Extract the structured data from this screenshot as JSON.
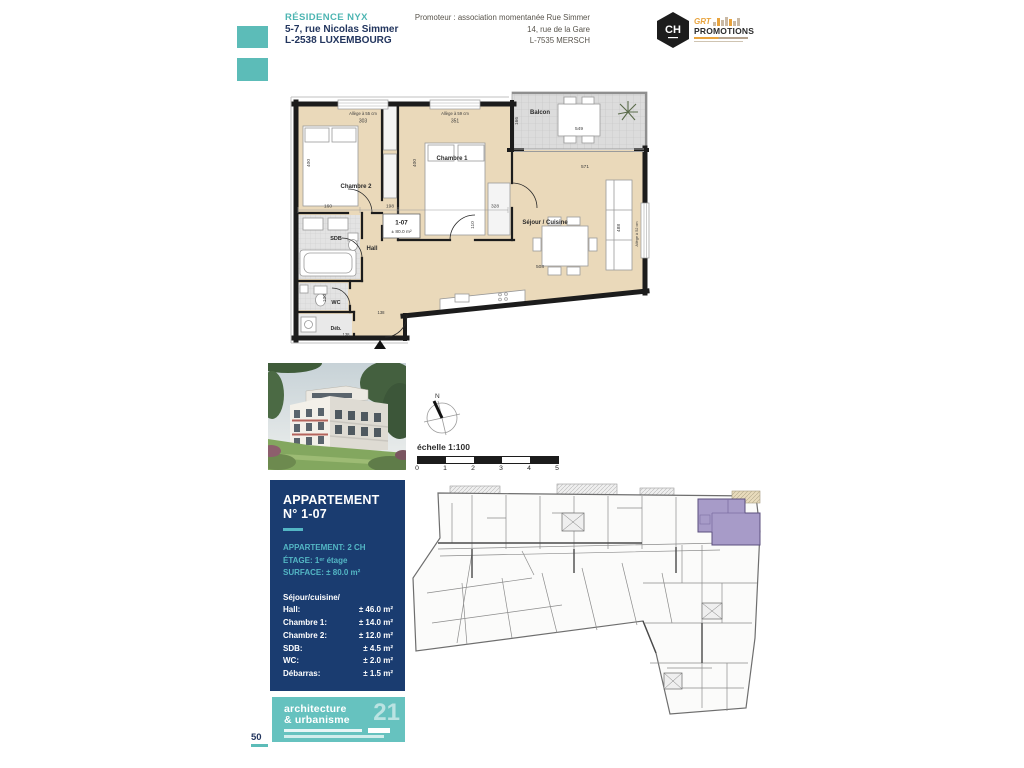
{
  "header": {
    "residence_name": "RÉSIDENCE NYX",
    "residence_address_1": "5-7, rue Nicolas Simmer",
    "residence_address_2": "L-2538 LUXEMBOURG",
    "promoter_line_1": "Promoteur : association momentanée Rue Simmer",
    "promoter_line_2": "14, rue de la Gare",
    "promoter_line_3": "L-7535 MERSCH",
    "ch_logo_text": "CH",
    "grt_logo_top": "GRT",
    "grt_logo_bottom": "PROMOTIONS"
  },
  "floor_plan": {
    "unit_id": "1-07",
    "unit_area": "± 80.0 m²",
    "rooms": {
      "chambre1": "Chambre 1",
      "chambre2": "Chambre 2",
      "balcon": "Balcon",
      "sejour_cuisine": "Séjour / Cuisine",
      "hall": "Hall",
      "sdb": "SDB",
      "wc": "WC",
      "debarras": "Déb."
    },
    "annotations": {
      "allege_55": "Allège à 55 cm",
      "allege_59": "Allège à 59 cm",
      "allege_52": "Allège à 52 cm"
    },
    "dims": {
      "chambre2_width": "303",
      "chambre1_width": "351",
      "chambre2_depth": "400",
      "chambre1_depth": "400",
      "balcon_depth": "166",
      "balcon_width": "549",
      "sejour_width": "571",
      "sejour_depth": "488",
      "sdb_width": "160",
      "hall_width": "198",
      "sejour_left": "328",
      "dining_width": "508",
      "corridor": "110",
      "wc_depth": "100",
      "hall_door": "138",
      "deb_width": "138"
    }
  },
  "compass": {
    "north": "N"
  },
  "scale": {
    "label": "échelle 1:100",
    "ticks": [
      "0",
      "1",
      "2",
      "3",
      "4",
      "5"
    ]
  },
  "info_box": {
    "title_line_1": "APPARTEMENT",
    "title_line_2": "N° 1-07",
    "specs": [
      {
        "label": "APPARTEMENT:",
        "value": "2 CH"
      },
      {
        "label": "ÉTAGE:",
        "value": "1ᵉʳ étage"
      },
      {
        "label": "SURFACE:",
        "value": "± 80.0 m²"
      }
    ],
    "rooms": [
      {
        "label": "Séjour/cuisine/",
        "value": ""
      },
      {
        "label": "Hall:",
        "value": "± 46.0 m²"
      },
      {
        "label": "Chambre 1:",
        "value": "± 14.0 m²"
      },
      {
        "label": "Chambre 2:",
        "value": "± 12.0 m²"
      },
      {
        "label": "SDB:",
        "value": "± 4.5 m²"
      },
      {
        "label": "WC:",
        "value": "± 2.0 m²"
      },
      {
        "label": "Débarras:",
        "value": "± 1.5 m²"
      }
    ],
    "balcony": {
      "label": "Balcon:",
      "value": "± 10.5 m²"
    }
  },
  "footer": {
    "logo_line_1": "architecture",
    "logo_line_2": "& urbanisme",
    "logo_number": "21",
    "page_number": "50"
  },
  "colors": {
    "teal": "#5cbcb8",
    "navy": "#1a3c70",
    "room_fill": "#ead9ba",
    "highlight_purple": "#a79bc8"
  }
}
